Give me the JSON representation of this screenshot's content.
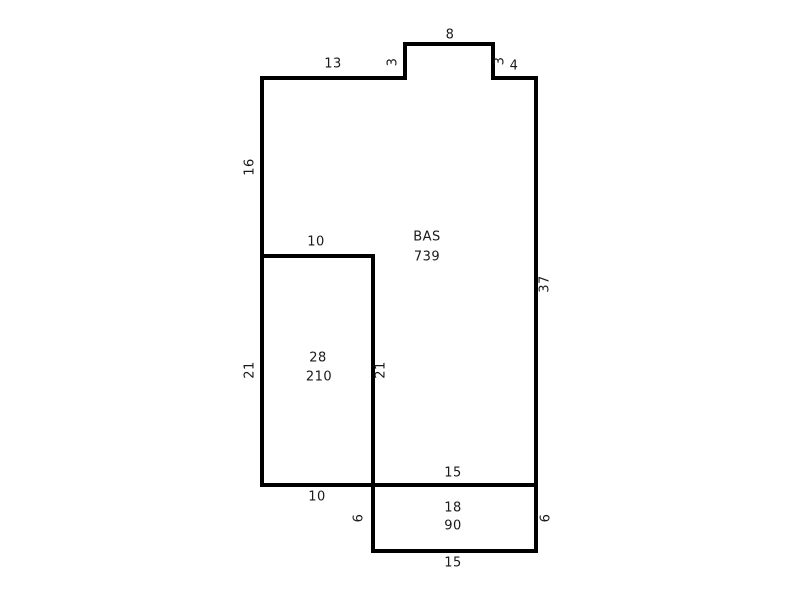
{
  "canvas": {
    "width": 800,
    "height": 600,
    "background_color": "#ffffff"
  },
  "style": {
    "line_color": "#000000",
    "text_color": "#1a1a1a"
  },
  "sketch": {
    "main_area": {
      "label": "BAS",
      "sqft": "739"
    },
    "left_room": {
      "dim": "28",
      "sqft": "210"
    },
    "extension": {
      "dim": "18",
      "sqft": "90"
    },
    "dims": {
      "bump_top": "8",
      "top_left": "13",
      "bump_left": "3",
      "bump_right": "3",
      "top_right": "4",
      "left_upper": "16",
      "left_room_top": "10",
      "right_wall": "37",
      "left_lower": "21",
      "left_room_right": "21",
      "main_bottom_right": "15",
      "main_bottom_left": "10",
      "ext_left": "6",
      "ext_right": "6",
      "ext_bottom": "15"
    }
  }
}
